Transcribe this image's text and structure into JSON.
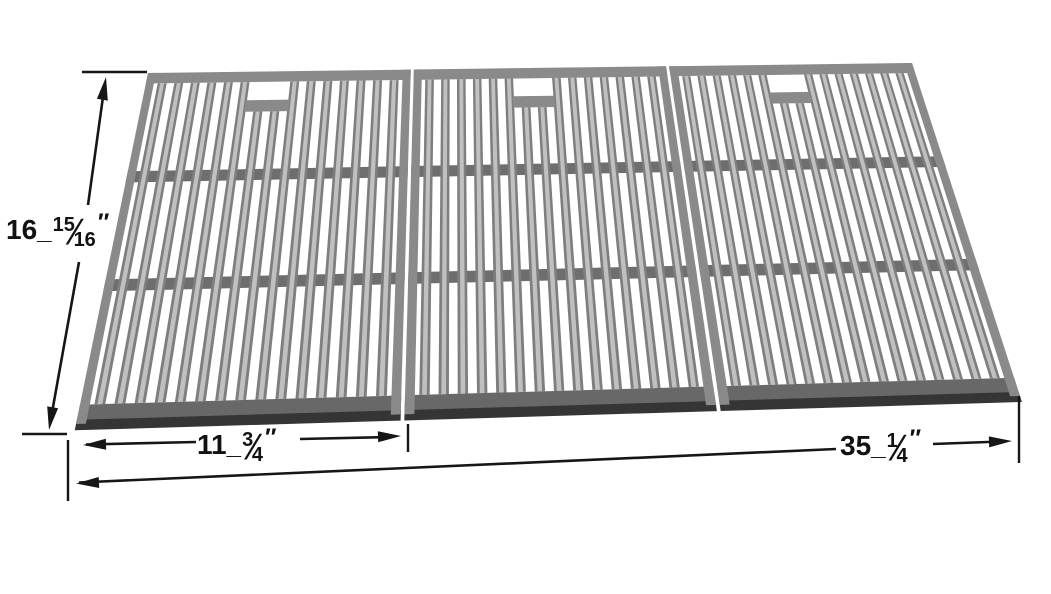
{
  "page": {
    "background": "#ffffff"
  },
  "annotations": {
    "height": {
      "whole": "16",
      "sep": "_",
      "num": "15",
      "slash": "⁄",
      "den": "16",
      "unit": "″"
    },
    "panel_width": {
      "whole": "11",
      "sep": "_",
      "num": "3",
      "slash": "⁄",
      "den": "4",
      "unit": "″"
    },
    "total_width": {
      "whole": "35",
      "sep": "_",
      "num": "1",
      "slash": "⁄",
      "den": "4",
      "unit": "″"
    }
  },
  "grate": {
    "panel_count": 3,
    "bars_per_panel": 15,
    "rails_per_panel": 2,
    "slot_bars": [
      6,
      7
    ],
    "colors": {
      "bar": "#7e7e7e",
      "bar_highlight": "#c0c0c0",
      "frame": "#8a8a8a",
      "frame_dark": "#686868",
      "lip": "#353535",
      "rail": "#6e6e6e",
      "annotation": "#161616"
    }
  }
}
